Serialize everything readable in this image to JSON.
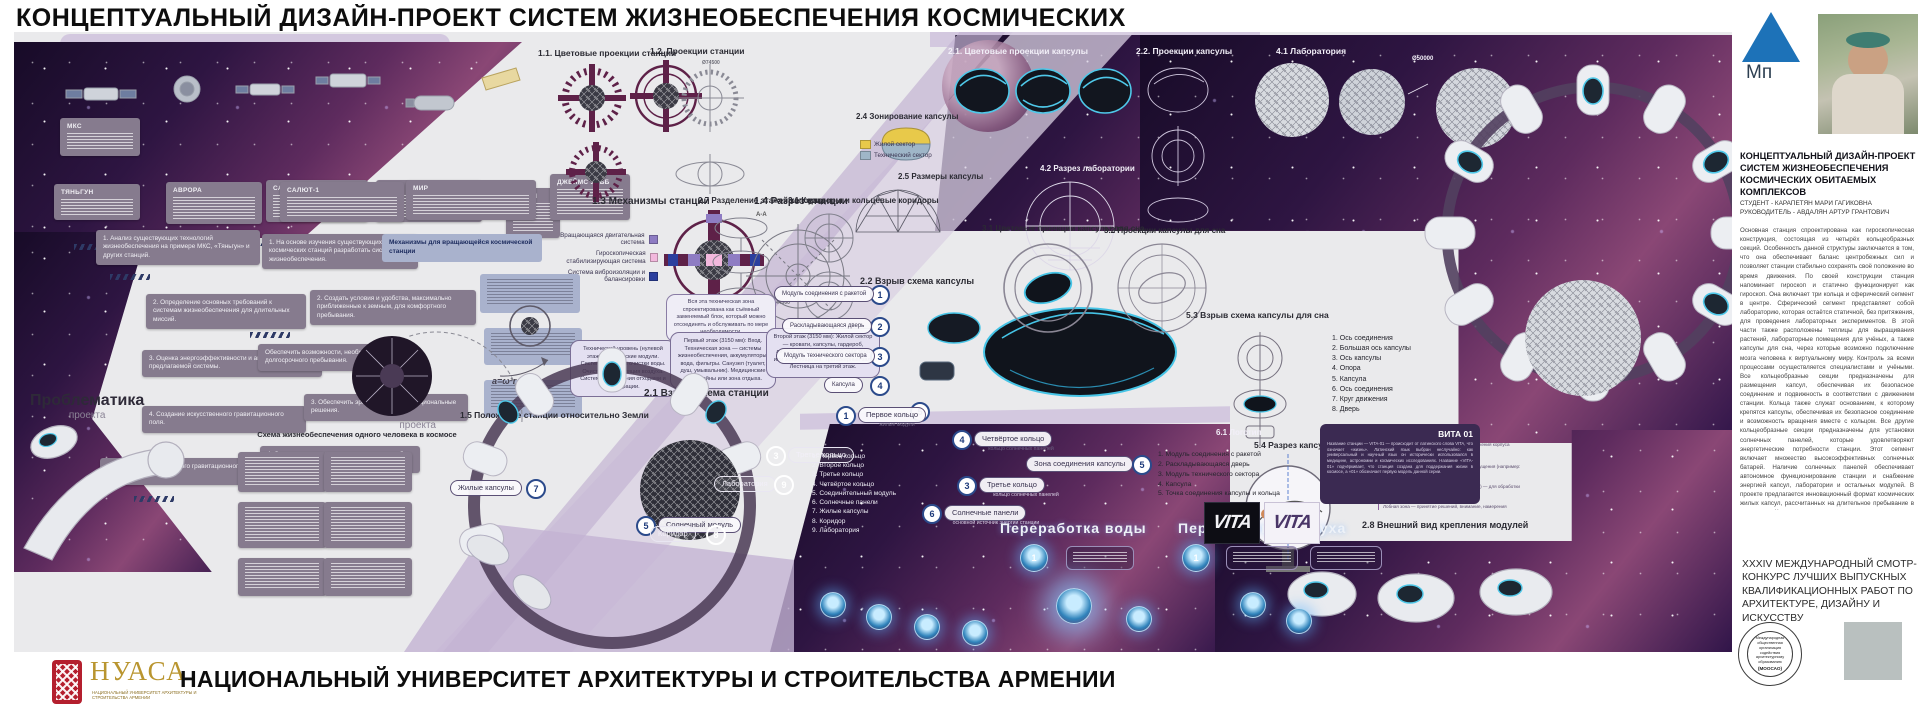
{
  "title": "КОНЦЕПТУАЛЬНЫЙ ДИЗАЙН-ПРОЕКТ СИСТЕМ ЖИЗНЕОБЕСПЕЧЕНИЯ КОСМИЧЕСКИХ",
  "footer": {
    "university": "НАЦИОНАЛЬНЫЙ УНИВЕРСИТЕТ АРХИТЕКТУРЫ И СТРОИТЕЛЬСТВА АРМЕНИИ",
    "logo_acronym": "НУАСА",
    "logo_caption": "НАЦИОНАЛЬНЫЙ УНИВЕРСИТЕТ АРХИТЕКТУРЫ И СТРОИТЕЛЬСТВА АРМЕНИИ"
  },
  "sidebar": {
    "logo_text": "Мп",
    "project_title": "КОНЦЕПТУАЛЬНЫЙ  ДИЗАЙН-ПРОЕКТ СИСТЕМ ЖИЗНЕОБЕСПЕЧЕНИЯ КОСМИЧЕСКИХ ОБИТАЕМЫХ КОМПЛЕКСОВ",
    "student": "СТУДЕНТ - КАРАПЕТЯН МАРИ ГАГИКОВНА",
    "advisor": "РУКОВОДИТЕЛЬ - АВДАЛЯН АРТУР ГРАНТОВИЧ",
    "description": "Основная станция спроектирована как гироскопическая конструкция, состоящая из четырёх кольцеобразных секций. Особенность данной структуры заключается в том, что она обеспечивает баланс центробежных сил и позволяет станции стабильно сохранять своё положение во время движения. По своей конструкции станция напоминает гироскоп и статично функционирует как гироскоп. Она включает три кольца и сферический сегмент в центре. Сферический сегмент представляет собой лабораторию, которая остаётся статичной, без притяжения, для проведения лабораторных экспериментов. В этой части также расположены теплицы для выращивания растений, лабораторные помещения для учёных, а также капсулы для сна, через которые возможно подключение мозга человека к виртуальному миру. Контроль за всеми процессами осуществляется специалистами и учёными. Все кольцеобразные секции предназначены для размещения капсул, обеспечивая их безопасное соединение и подвижность в соответствии с движением станции. Кольца также служат основанием, к которому крепятся капсулы, обеспечивая их безопасное соединение и возможность вращения вместе с кольцом. Все другие кольцеобразные секции предназначены для установки солнечных панелей, которые удовлетворяют энергетические потребности станции. Этот сегмент включает множество высокоэффективных солнечных батарей. Наличие солнечных панелей обеспечивает автономное функционирование станции и снабжение энергией капсул, лаборатории и остальных модулей. В проекте предлагается инновационный формат космических жилых капсул, рассчитанных на длительное пребывание в космосе. Капсула включает автономные системы жизнеобеспечения, способные в течение определённого времени самостоятельно выполнять функции очистки воздуха, циркуляции воды, регулирования температуры и контроля атмосферных условий. Одной из особенностей капсулы является наличие технического модуля с внешним отдельным отсеком, который служит для пополнения и перезарядки систем жизнеобеспечения. Данный технический модуль может быть легко демонтирован в космических условиях, если внутренние ресурсы (например, кислород, вода или энергетические запасы) исчерпаны. После перезарядки модуль устанавливается обратно на то же место без нарушения основной структуры капсулы, при этом он может быть заменён другим внешним техническим модулем, чтобы участок не оставался пустым.",
    "competition": "XXXIV МЕЖДУНАРОДНЫЙ СМОТР-КОНКУРС ЛУЧШИХ ВЫПУСКНЫХ КВАЛИФИКАЦИОННЫХ РАБОТ ПО АРХИТЕКТУРЕ, ДИЗАЙНУ И ИСКУССТВУ",
    "stamp_text": "Международная общественная организация содействия архитектурному образованию",
    "stamp_abbr": "(МООСАО)"
  },
  "sections": {
    "s11": "1.1. Цветовые проекции станции",
    "s12": "1.2. Проекции станции",
    "s13": "1.3 Механизмы станции",
    "s14": "1.4 Разрез станции",
    "s15": "1.5 Положение станции относительно Земли",
    "s21c": "2.1. Цветовые проекции капсулы",
    "s22p": "2.2. Проекции капсулы",
    "s21e": "2.1 Взрыв схема станции",
    "s22e": "2.2 Взрыв схема капсулы",
    "s24": "2.4 Зонирование капсулы",
    "s25": "2.5 Размеры капсулы",
    "s27": "2.7 Разделение этажей капсулы",
    "s28": "2.8 Внешний вид крепления модулей",
    "s31k": "3.1 Коридоры и кольцевые коридоры",
    "s31s": "3.1 Цветовые проекции капсулы для сна",
    "s32s": "3.2 Проекции капсулы для сна",
    "s41": "4.1 Лаборатория",
    "s42": "4.2 Разрез лаборатории",
    "s53": "5.3 Взрыв схема капсулы для сна",
    "s54": "5.4 Разрез капсулы для сна",
    "s61": "6.1 Логотип"
  },
  "problems": {
    "title": "Проблематика",
    "subtitle": "проекта",
    "items": [
      "1. Анализ существующих технологий жизнеобеспечения на примере МКС, «Тяньгун» и других станций.",
      "2. Определение основных требований к системам жизнеобеспечения для длительных миссий.",
      "3. Оценка энергоэффективности и автономности предлагаемой системы.",
      "4. Создание искусственного гравитационного поля.",
      "5. Создание искусственного гравитационного поля."
    ]
  },
  "goals": {
    "title": "Цель",
    "subtitle": "проекта",
    "mechanisms_note": "Механизмы для вращающейся космической станции",
    "items": [
      "1. На основе изучения существующих космических станций разработать системы жизнеобеспечения.",
      "2. Создать условия и удобства, максимально приближенные к земным, для комфортного пребывания.",
      "Обеспечить возможности, необходимые для долгосрочного пребывания.",
      "3. Обеспечить эргономичные и функциональные решения.",
      "4. Спроектировать сегмент, предназначенный для лаборатории."
    ]
  },
  "satellites": [
    "МКС",
    "ТЯНЬГУН",
    "АВРОРА",
    "САЛЮТ-1",
    "МИР",
    "ХАББЛ",
    "ДЖЕЙМС УЭББ"
  ],
  "legend13": [
    "Вращающаяся двигательная система",
    "Гироскопическая стабилизирующая система",
    "Система виброизоляции и балансировки"
  ],
  "zoning": {
    "res": "Жилой сектор",
    "tech": "Технический сектор"
  },
  "floors": [
    "Технический уровень (нулевой этаж): Технические модули. Система подачи и очистки воды. Очистка и циркуляция воздуха. Система управления отходами и фильтрации.",
    "Первый этаж (3150 мм): Вход. Техническая зона — системы жизнеобеспечения, аккумуляторы, вода, фильтры. Санузел (туалет, душ, умывальник). Медицинские кронштейны или зона отдыха.",
    "Второй этаж (3150 мм): Жилой сектор — кровати, капсулы, гардероб, личное пространство. Рабочая зона или зона общения. Тренажёрный зал. Лестница на третий этаж."
  ],
  "tech_note": "Вся эта техническая зона спроектирована как съёмный заменяемый блок, который можно отсоединять и обслуживать по мере необходимости.",
  "formula": "a=ω²r",
  "dims": {
    "lab": "Ø50000",
    "station": "Ø74500",
    "section": "44500",
    "aa": "А-А"
  },
  "ring_list": [
    "1. Первое кольцо",
    "2. Второе кольцо",
    "3. Третье кольцо",
    "4. Четвёртое кольцо",
    "5. Соединительный модуль",
    "6. Солнечные панели",
    "7. Жилые капсулы",
    "8. Коридор",
    "9. Лаборатория"
  ],
  "callouts": {
    "c1": {
      "n": "1",
      "label": "Первое кольцо",
      "sub": "жилые модули"
    },
    "c3": {
      "n": "3",
      "label": "Третье кольцо",
      "sub": "кольцо солнечных панелей"
    },
    "c3b": {
      "n": "3",
      "label": "Третье кольцо"
    },
    "c4": {
      "n": "4",
      "label": "Четвёртое кольцо",
      "sub": "кольцо солнечных панелей"
    },
    "c5": {
      "n": "5",
      "label": "Зона соединения капсулы"
    },
    "c5b": {
      "n": "5",
      "label": "Солнечный модуль"
    },
    "c6": {
      "n": "6",
      "label": "Солнечные панели",
      "sub": "основной источник энергии станции"
    },
    "c7": {
      "n": "7",
      "label": "Жилые капсулы"
    },
    "c8": {
      "n": "8",
      "label": "Коридор"
    },
    "c9": {
      "n": "9",
      "label": "Лаборатория"
    }
  },
  "capsule_parts": [
    "1. Модуль соединения с ракетой",
    "2. Раскладывающаяся дверь",
    "3. Модуль технического сектора",
    "4. Капсула",
    "5. Точка соединения капсулы и кольца"
  ],
  "capsule_parts_short": [
    "Модуль соединения с ракетой",
    "Раскладывающаяся дверь",
    "Модуль технического сектора",
    "Капсула",
    "Точка соединения капсулы и кольца"
  ],
  "sleep_parts": [
    "1. Ось соединения",
    "2. Большая ось капсулы",
    "3. Ось капсулы",
    "4. Опора",
    "5. Капсула",
    "6. Ось соединения",
    "7. Круг движения",
    "8. Дверь"
  ],
  "brain_labels": [
    "Двигательная оболочка — отвечает за движения корпуса",
    "Сенсорная оболочка — отвечает за ощущения (например: истома)",
    "Зрительная оболочка (затылочная зона) — для обработки визуальной информации",
    "Лобная зона — принятие решений, внимание, намерения"
  ],
  "processing": {
    "water": "Переработка воды",
    "air": "Переработка воздуха",
    "n1": "1",
    "n2": "2"
  },
  "life_scheme_title": "Схема жизнеобеспечения одного человека в космосе",
  "vita": {
    "name": "ВИТА 01",
    "text": "Название станции — VITA-01 — происходит от латинского слова VITA, что означает «жизнь». Латинский язык выбран неслучайно: как универсальный и научный язык он исторически использовался в медицине, астрономии и космических исследованиях. Название «VITA-01» подчёркивает, что станция создана для поддержания жизни в космосе, а «01» обозначает первую модель данной серии.",
    "logo": "VITA"
  },
  "colors": {
    "accent_cyan": "#4fc8e9",
    "legend_purple": "#8e7cc3",
    "legend_pink": "#f2b8dd",
    "legend_blue": "#2b3f9e",
    "zone_res": "#e8c94a",
    "zone_tech": "#9fb6c8",
    "brand_blue": "#1d72b8"
  }
}
